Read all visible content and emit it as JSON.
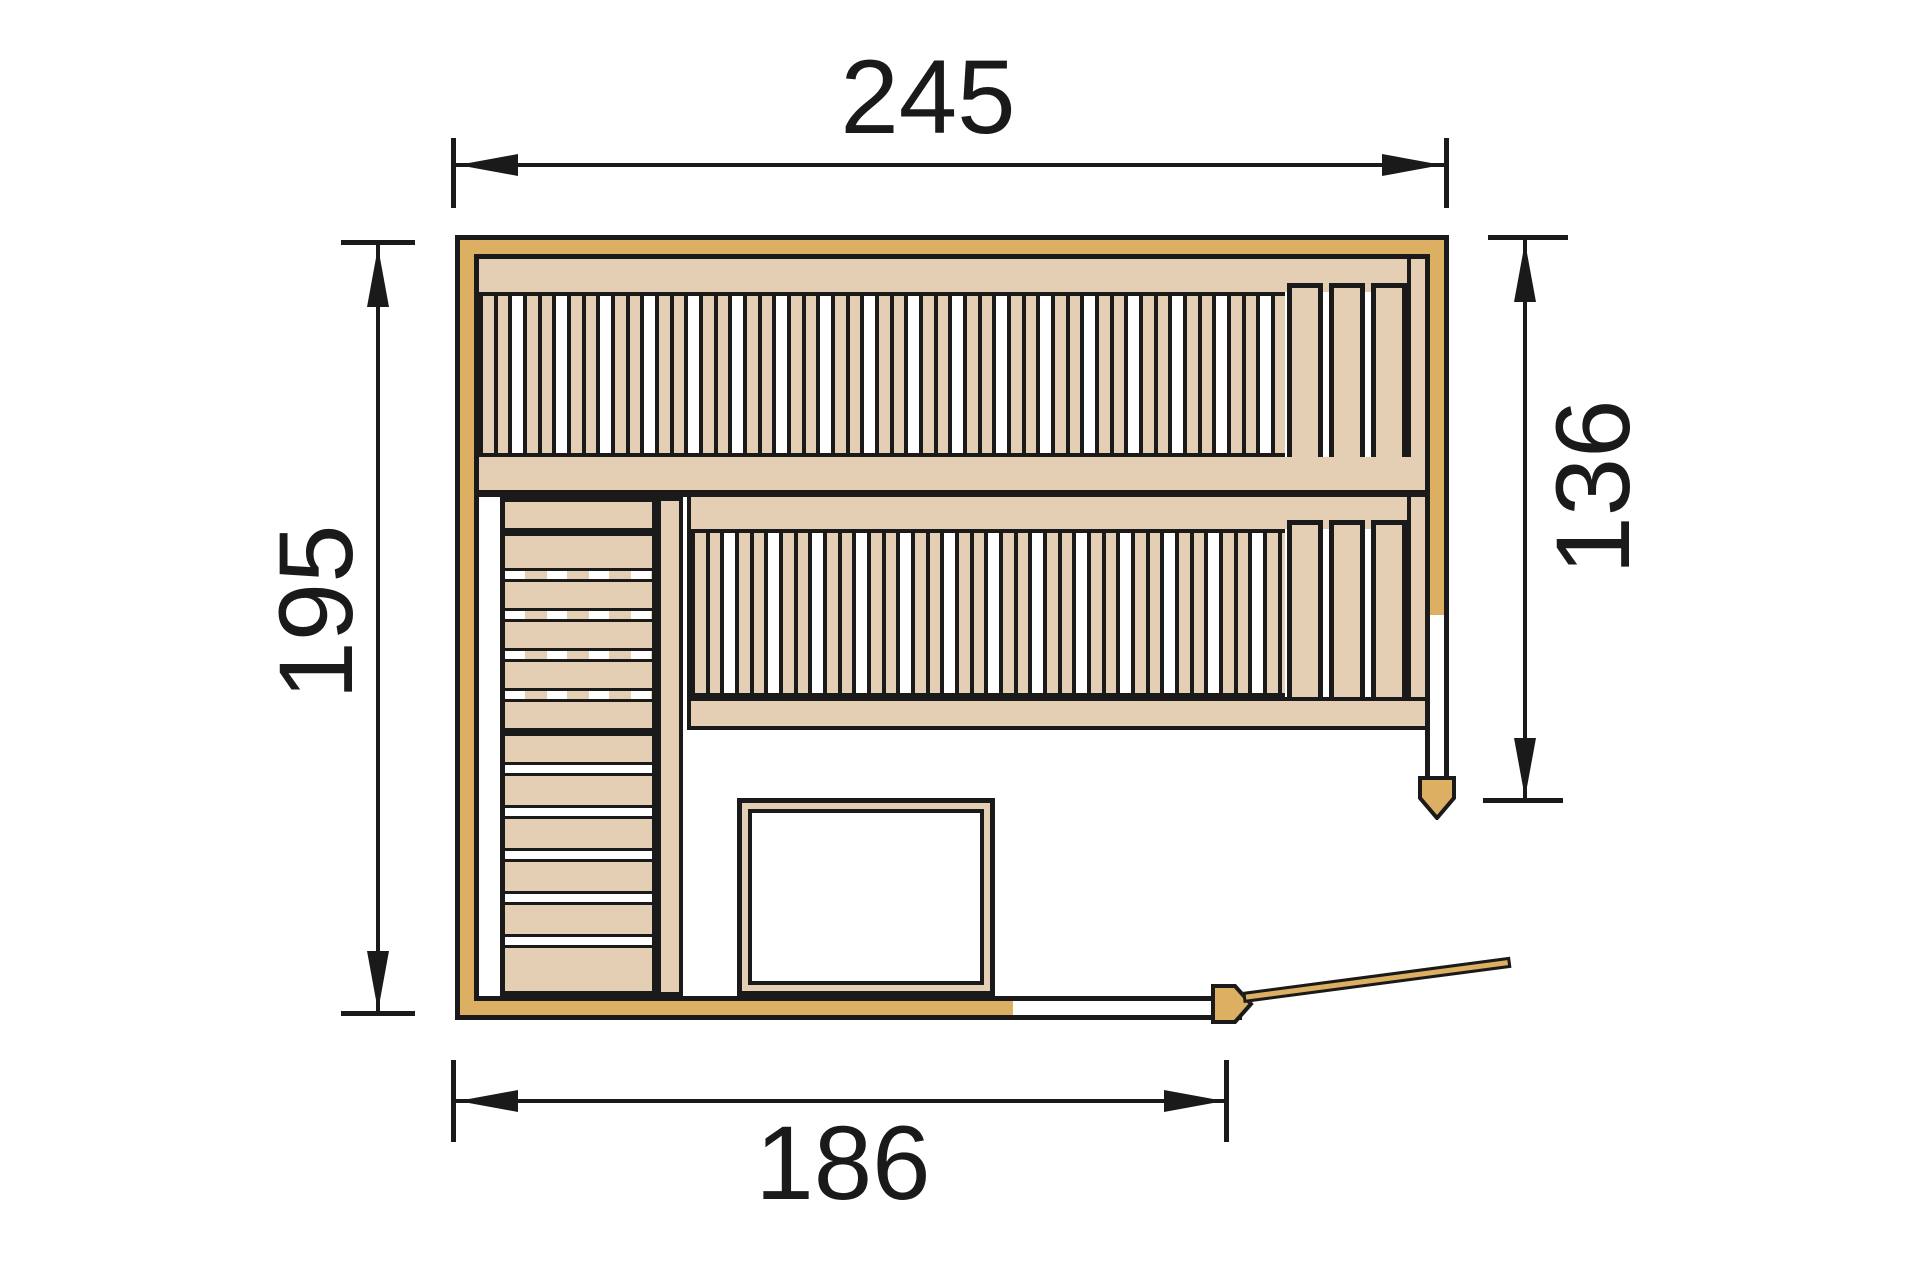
{
  "drawing": {
    "type_label": "sauna-floor-plan-top-view",
    "dimensions": {
      "width_top": "245",
      "height_left": "195",
      "right_inner": "136",
      "bottom_front": "186"
    },
    "colors": {
      "wall_gold": "#DCAF63",
      "wood_tan": "#E4CFB5",
      "line_black": "#1A1A1A",
      "background": "#FFFFFF"
    }
  }
}
